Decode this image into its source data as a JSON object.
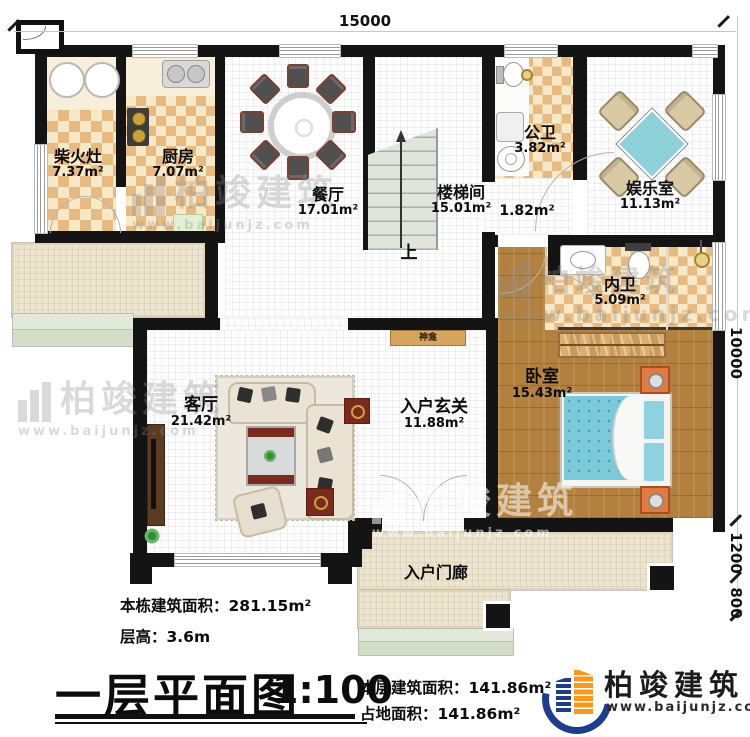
{
  "dimensions": {
    "top_width": "15000",
    "right_main": "10000",
    "right_porch": "1200",
    "right_steps": "800"
  },
  "rooms": [
    {
      "name": "柴火灶",
      "area": "7.37m²"
    },
    {
      "name": "厨房",
      "area": "7.07m²"
    },
    {
      "name": "餐厅",
      "area": "17.01m²"
    },
    {
      "name": "楼梯间",
      "area": "15.01m²"
    },
    {
      "name": "公卫",
      "area": "3.82m²"
    },
    {
      "name": "娱乐室",
      "area": "11.13m²"
    },
    {
      "name": "",
      "area": "1.82m²"
    },
    {
      "name": "内卫",
      "area": "5.09m²"
    },
    {
      "name": "卧室",
      "area": "15.43m²"
    },
    {
      "name": "客厅",
      "area": "21.42m²"
    },
    {
      "name": "入户玄关",
      "area": "11.88m²"
    },
    {
      "name": "入户门廊",
      "area": ""
    }
  ],
  "annotations": {
    "stairs_up": "上",
    "shrine": "神龛"
  },
  "title_block": {
    "building_total_area": "本栋建筑面积：281.15m²",
    "floor_height": "层高：3.6m",
    "plan_title": "一层平面图",
    "scale": "1:100",
    "floor_area": "本层建筑面积：141.86m²",
    "footprint_area": "占地面积：141.86m²"
  },
  "logo": {
    "brand": "柏竣建筑",
    "url": "www.baijunjz.com"
  },
  "watermark": {
    "brand": "柏竣建筑",
    "url": "www.baijunjz.com"
  },
  "colors": {
    "wall": "#141414",
    "checker_tan": "#e6ba81",
    "wood": "#b2813f",
    "outdoor": "#ece4cc",
    "water_blue": "#7cc9d9",
    "logo_blue": "#1d3e8f",
    "logo_orange": "#f6991e"
  }
}
